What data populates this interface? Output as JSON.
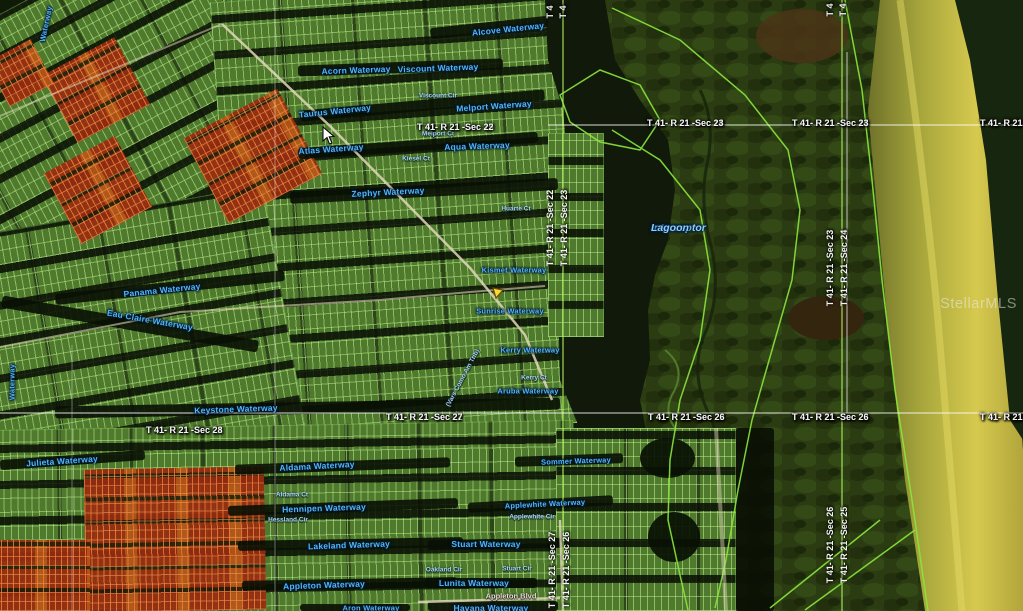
{
  "map": {
    "watermark": "StellarMLS",
    "lagoon_label": {
      "line1": "Interceptor",
      "line2": "Lagoon"
    },
    "waterway_labels": [
      {
        "text": "Alcove Waterway",
        "x": 508,
        "y": 29,
        "rot": -6
      },
      {
        "text": "Acorn Waterway",
        "x": 356,
        "y": 70,
        "rot": -2
      },
      {
        "text": "Viscount Waterway",
        "x": 438,
        "y": 68,
        "rot": -2
      },
      {
        "text": "Melport Waterway",
        "x": 494,
        "y": 106,
        "rot": -4
      },
      {
        "text": "Taurus Waterway",
        "x": 335,
        "y": 111,
        "rot": -6
      },
      {
        "text": "Atlas Waterway",
        "x": 331,
        "y": 149,
        "rot": -4
      },
      {
        "text": "Aqua Waterway",
        "x": 477,
        "y": 146,
        "rot": -2
      },
      {
        "text": "Zephyr Waterway",
        "x": 388,
        "y": 192,
        "rot": -3
      },
      {
        "text": "Panama Waterway",
        "x": 162,
        "y": 290,
        "rot": -6
      },
      {
        "text": "Eau Claire Waterway",
        "x": 150,
        "y": 320,
        "rot": 10
      },
      {
        "text": "Kismet Waterway",
        "x": 514,
        "y": 270,
        "rot": 0,
        "size": 7.5
      },
      {
        "text": "Sunrise Waterway",
        "x": 510,
        "y": 311,
        "rot": 0,
        "size": 7.5
      },
      {
        "text": "Kerry Waterway",
        "x": 530,
        "y": 350,
        "rot": 0,
        "size": 7.5
      },
      {
        "text": "Aruba Waterway",
        "x": 528,
        "y": 391,
        "rot": 0,
        "size": 7.5
      },
      {
        "text": "Keystone Waterway",
        "x": 236,
        "y": 409,
        "rot": -2
      },
      {
        "text": "Julieta Waterway",
        "x": 62,
        "y": 461,
        "rot": -4
      },
      {
        "text": "Aldama Waterway",
        "x": 317,
        "y": 466,
        "rot": -3
      },
      {
        "text": "Sommer Waterway",
        "x": 576,
        "y": 461,
        "rot": -2,
        "size": 7.5
      },
      {
        "text": "Hennipen Waterway",
        "x": 324,
        "y": 508,
        "rot": -2
      },
      {
        "text": "Applewhite Waterway",
        "x": 545,
        "y": 504,
        "rot": -3,
        "size": 7.5
      },
      {
        "text": "Lakeland Waterway",
        "x": 349,
        "y": 545,
        "rot": -2
      },
      {
        "text": "Stuart Waterway",
        "x": 486,
        "y": 544,
        "rot": 0
      },
      {
        "text": "Appleton Waterway",
        "x": 324,
        "y": 585,
        "rot": -2
      },
      {
        "text": "Lunita Waterway",
        "x": 474,
        "y": 583,
        "rot": 0
      },
      {
        "text": "Havana Waterway",
        "x": 491,
        "y": 608,
        "rot": 0
      },
      {
        "text": "Aron Waterway",
        "x": 371,
        "y": 608,
        "rot": 0,
        "size": 7.5
      },
      {
        "text": "Waterway",
        "x": 12,
        "y": 382,
        "rot": -90,
        "size": 7.5
      },
      {
        "text": "Waterway",
        "x": 46,
        "y": 24,
        "rot": -78,
        "size": 7.5
      }
    ],
    "street_labels": [
      {
        "text": "Viscount Cir",
        "x": 438,
        "y": 96
      },
      {
        "text": "Melport Ct",
        "x": 438,
        "y": 134
      },
      {
        "text": "Kiesel Ct",
        "x": 416,
        "y": 159
      },
      {
        "text": "Huarte Ct",
        "x": 516,
        "y": 209
      },
      {
        "text": "Kerry Ct",
        "x": 534,
        "y": 378
      },
      {
        "text": "Aldama Ct",
        "x": 292,
        "y": 495
      },
      {
        "text": "Hessland Cir",
        "x": 288,
        "y": 520
      },
      {
        "text": "Applewhite Cir",
        "x": 532,
        "y": 517
      },
      {
        "text": "Oakland Cir",
        "x": 444,
        "y": 570
      },
      {
        "text": "Stuart Cir",
        "x": 517,
        "y": 569
      },
      {
        "text": "(Vars Como Am Trib)",
        "x": 463,
        "y": 378,
        "rot": -62
      },
      {
        "text": "Appleton Blvd",
        "x": 511,
        "y": 596,
        "road": true
      }
    ],
    "section_labels_horizontal": [
      {
        "top": "T 41- R 21 -Sec 15",
        "bottom": "T 41- R 21 -Sec 22",
        "x": 417,
        "cy": 122
      },
      {
        "top": "T 41- R 21 -Sec 14",
        "bottom": "T 41- R 21 -Sec 23",
        "x": 647,
        "cy": 118
      },
      {
        "top": "T 41- R 21 -Sec 14",
        "bottom": "T 41- R 21 -Sec 23",
        "x": 792,
        "cy": 118
      },
      {
        "top": "T 41- R 21 -Sec 13",
        "bottom": "T 41- R 21 -Sec 24",
        "x": 980,
        "cy": 118
      },
      {
        "top": "T 41- R 21 -Sec 21",
        "bottom": "T 41- R 21 -Sec 28",
        "x": 146,
        "cy": 425
      },
      {
        "top": "T 41- R 21 -Sec 22",
        "bottom": "T 41- R 21 -Sec 27",
        "x": 386,
        "cy": 412
      },
      {
        "top": "T 41- R 21 -Sec 23",
        "bottom": "T 41- R 21 -Sec 26",
        "x": 648,
        "cy": 412
      },
      {
        "top": "T 41- R 21 -Sec 23",
        "bottom": "T 41- R 21 -Sec 26",
        "x": 792,
        "cy": 412
      },
      {
        "top": "T 41- R 21 -Sec 24",
        "bottom": "T 41- R 21 -Sec 25",
        "x": 980,
        "cy": 412
      }
    ],
    "section_labels_vertical": [
      {
        "west": "T 41- R 21 -Sec 22",
        "east": "T 41- R 21 -Sec 23",
        "x": 558,
        "cy": 228
      },
      {
        "west": "T 41- R 21 -Sec 27",
        "east": "T 41- R 21 -Sec 26",
        "x": 560,
        "cy": 570
      },
      {
        "west": "T 41- R 21 -Sec 23",
        "east": "T 41- R 21 -Sec 24",
        "x": 838,
        "cy": 268
      },
      {
        "west": "T 41- R 21 -Sec 26",
        "east": "T 41- R 21 -Sec 25",
        "x": 838,
        "cy": 545
      }
    ],
    "section_edge_stubs": [
      {
        "text": "T 4",
        "x": 551,
        "y": 12
      },
      {
        "text": "T 4",
        "x": 564,
        "y": 12
      },
      {
        "text": "T 4",
        "x": 831,
        "y": 10
      },
      {
        "text": "T 4",
        "x": 844,
        "y": 10
      }
    ],
    "icons": [
      {
        "name": "map-pin-icon",
        "x": 497,
        "y": 292,
        "color": "#f6d73c"
      },
      {
        "name": "cursor-icon",
        "x": 323,
        "y": 127,
        "color": "#ffffff"
      }
    ],
    "colors": {
      "parcel_green": "#4f7a2e",
      "parcel_outline": "#bef08c",
      "canal_dark": "#0a1004",
      "red_parcels": "#b03014",
      "preserve": "#2b3b12",
      "beach_band": "#c9bd45",
      "waterway_label_blue": "#54b4f4",
      "section_label_white": "#f4f4f4",
      "boundary_green": "#8ae63c"
    }
  }
}
